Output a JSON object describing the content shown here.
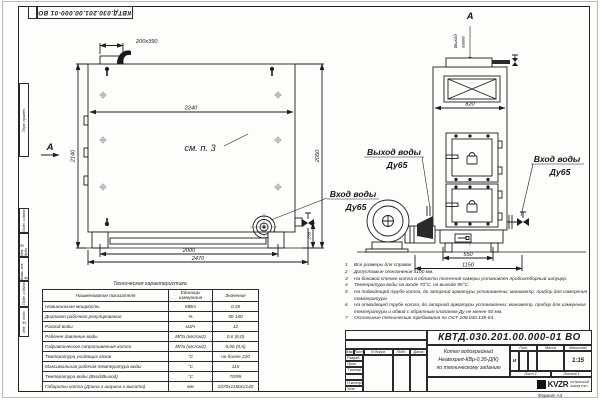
{
  "page": {
    "doc_number_top": "КВТД.030.201.00.000-01 ВО",
    "format_label": "Формат А3"
  },
  "margin": {
    "labels": [
      "Перв. примен.",
      "Подп. и дата",
      "Инв. № дубл.",
      "Взам. инв. №",
      "Подп. и дата",
      "Инв. № подл."
    ]
  },
  "side_view": {
    "dim_flue": "200x390",
    "dim_top": "2240",
    "dim_left": "2140",
    "dim_right": "2050",
    "dim_base": "2000",
    "dim_overall": "2470",
    "dim_foot": "255",
    "see_note": "см. п. 3",
    "view_label": "А"
  },
  "front_view": {
    "view_label": "А",
    "gas_out_1": "Выход",
    "gas_out_2": "газов",
    "dim_width": "820",
    "dim_base": "550",
    "dim_overall": "1150",
    "water_out_1": "Выход воды",
    "water_out_2": "Ду65",
    "water_in_left_1": "Вход воды",
    "water_in_left_2": "Ду65",
    "water_in_right_1": "Вход воды",
    "water_in_right_2": "Ду65"
  },
  "tech_table": {
    "title": "Техническая характеристика",
    "col_name": "Наименование показателя",
    "col_units": "Единицы измерения",
    "col_value": "Значение",
    "rows": [
      {
        "name": "Номинальная мощность",
        "units": "МВт",
        "value": "0,35"
      },
      {
        "name": "Диапазон рабочего регулирования",
        "units": "%",
        "value": "50-100"
      },
      {
        "name": "Расход воды",
        "units": "м3/ч",
        "value": "12"
      },
      {
        "name": "Рабочее давление воды",
        "units": "МПа (кгс/см2)",
        "value": "0,6 (6,0)"
      },
      {
        "name": "Гидравлическое сопротивление котла",
        "units": "МПа (кгс/см2)",
        "value": "0,06 (0,6)"
      },
      {
        "name": "Температура уходящих газов",
        "units": "°С",
        "value": "не более 220"
      },
      {
        "name": "Максимальная рабочая температура воды",
        "units": "°С",
        "value": "115"
      },
      {
        "name": "Температура воды (Вход/Выход)",
        "units": "°С",
        "value": "70/95"
      },
      {
        "name": "Габариты котла (Длина х ширина х высота)",
        "units": "мм",
        "value": "2470x1150x2140"
      }
    ]
  },
  "notes": {
    "items": [
      {
        "num": "1",
        "text": "Все размеры для справок"
      },
      {
        "num": "2",
        "text": "Допустимые отклонения ±100 мм."
      },
      {
        "num": "3",
        "text": "На боковой стенке котла в области топочной камеры установлен пробоотборный штуцер."
      },
      {
        "num": "4",
        "text": "Температура воды на входе 70°С, на выходе 95°С."
      },
      {
        "num": "5",
        "text": "На подводящей трубе котла, до запорной арматуры установлены: манометр, прибор для измерения температуры"
      },
      {
        "num": "6",
        "text": "На отводящей трубе котла, до запорной арматуры установлены: манометр, прибор для измерения температуры и обвод с обратным клапаном Ду не менее 50 мм."
      },
      {
        "num": "7",
        "text": "Остальные технические требования по ОСТ 108.030.135-84."
      }
    ]
  },
  "title_block": {
    "doc_number": "КВТД.030.201.00.000-01 ВО",
    "header_cells": [
      "Изм.",
      "Лист",
      "N докум.",
      "Подп.",
      "Дата"
    ],
    "roles": [
      "Разраб.",
      "Пров.",
      "Т.контр.",
      "",
      "Н.контр.",
      "Утв."
    ],
    "title_line1": "Котел водогрейный",
    "title_line2": "Heatexpert-КВр-0,35-Д(К)",
    "title_line3": "по техническому заданию",
    "lit_header": "Лит.",
    "lit_value": "И",
    "mass_header": "Масса",
    "scale_header": "Масштаб",
    "scale_value": "1:15",
    "sheet_text": "Лист 1",
    "sheets_text": "Листов 1",
    "logo_text": "KVZR",
    "company_line1": "КОТЕЛЬНЫЙ",
    "company_line2": "ЗАВОД РЭП"
  }
}
